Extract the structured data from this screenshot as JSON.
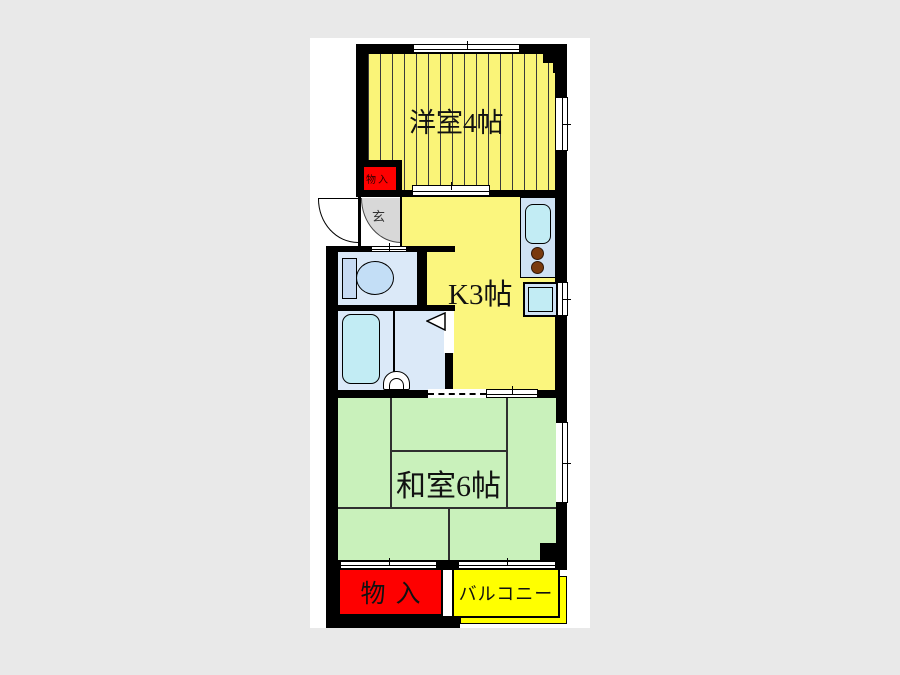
{
  "title": "apartment-floor-plan",
  "colors": {
    "bg": "#e9e9e9",
    "canvas": "#ffffff",
    "wall": "#000000",
    "western_room": "#faf478",
    "stripe": "#3a3a3a",
    "kitchen": "#fbf67e",
    "tatami_room": "#c9f1bb",
    "wet_room": "#dbe9f8",
    "fixture_blue": "#c6daf2",
    "fixture_cyan": "#c2ecf4",
    "counter_blue": "#cfe2f4",
    "burner_brown": "#7a3a0e",
    "storage_red": "#fe0000",
    "balcony_yellow": "#ffff00",
    "genkan_gray": "#d8d8d8"
  },
  "rooms": {
    "western": {
      "label": "洋室4帖"
    },
    "kitchen": {
      "label": "K3帖"
    },
    "japanese": {
      "label": "和室6帖"
    },
    "storage_top": {
      "label": "物入"
    },
    "storage_bottom": {
      "label": "物入"
    },
    "balcony": {
      "label": "バルコニー"
    },
    "entrance": {
      "label": "玄"
    }
  }
}
